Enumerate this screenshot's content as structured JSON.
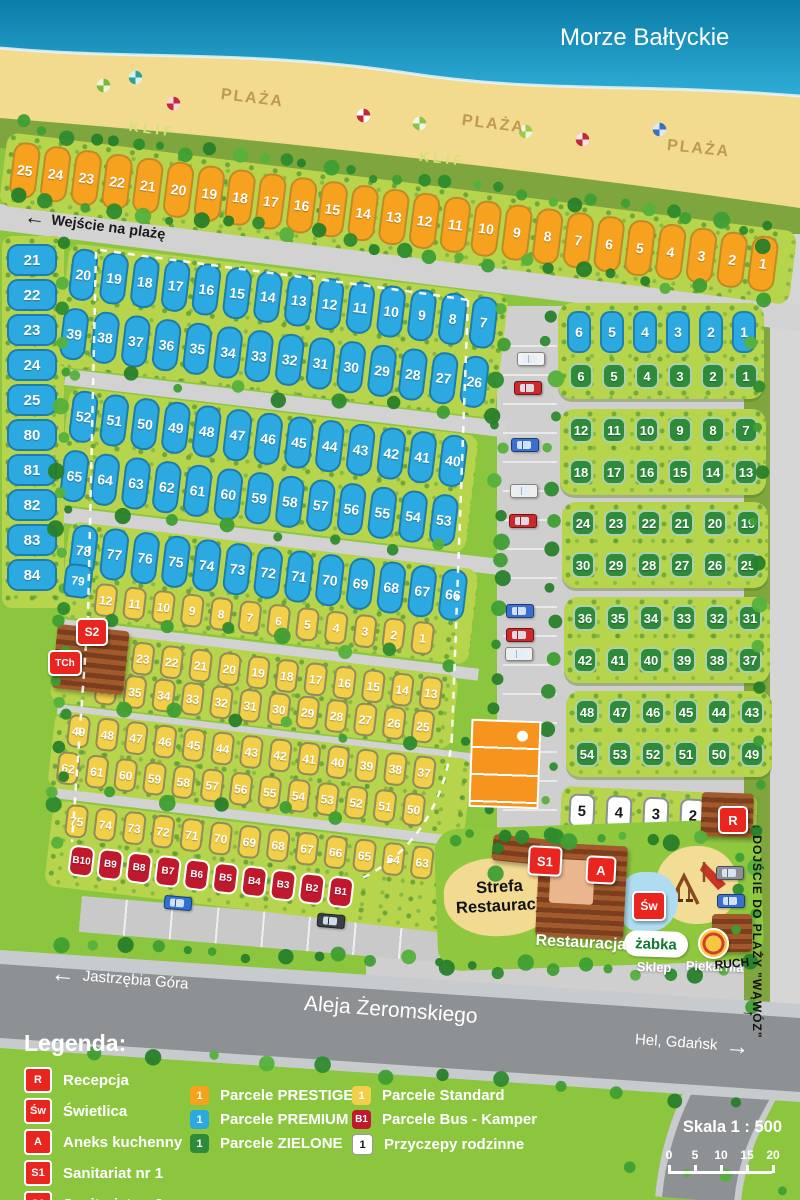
{
  "sea_label": "Morze Bałtyckie",
  "beach": {
    "plaza": [
      "PLAŻA",
      "PLAŻA",
      "PLAŻA"
    ],
    "klif": [
      "KLIF",
      "KLIF"
    ]
  },
  "paths": {
    "beach_entrance": "Wejście na plażę",
    "gorge_access": "DOJŚCIE DO PLAŻY \"WĄWÓZ\""
  },
  "roads": {
    "left_direction": "Jastrzębia Góra",
    "main_street": "Aleja Żeromskiego",
    "right_direction": "Hel, Gdańsk"
  },
  "zones": {
    "restaurant_area": "Strefa Restauracji",
    "restaurant": "Restauracja",
    "shop_logo": "żabka",
    "shop": "Sklep",
    "bakery": "Piekarnia",
    "kiosk": "RUCH"
  },
  "facilities": {
    "reception": "R",
    "common_room": "Św",
    "kitchen": "A",
    "sanitary1": "S1",
    "sanitary2": "S2",
    "chem_toilet": "TCh"
  },
  "plots": {
    "prestige": [
      "25",
      "24",
      "23",
      "22",
      "21",
      "20",
      "19",
      "18",
      "17",
      "16",
      "15",
      "14",
      "13",
      "12",
      "11",
      "10",
      "9",
      "8",
      "7",
      "6",
      "5",
      "4",
      "3",
      "2",
      "1"
    ],
    "premium_left_column": [
      "21",
      "22",
      "23",
      "24",
      "25",
      "80",
      "81",
      "82",
      "83",
      "84"
    ],
    "premium_rows": [
      [
        "20",
        "19",
        "18",
        "17",
        "16",
        "15",
        "14",
        "13",
        "12",
        "11",
        "10",
        "9",
        "8",
        "7"
      ],
      [
        "39",
        "38",
        "37",
        "36",
        "35",
        "34",
        "33",
        "32",
        "31",
        "30",
        "29",
        "28",
        "27",
        "26"
      ],
      [
        "52",
        "51",
        "50",
        "49",
        "48",
        "47",
        "46",
        "45",
        "44",
        "43",
        "42",
        "41",
        "40"
      ],
      [
        "65",
        "64",
        "63",
        "62",
        "61",
        "60",
        "59",
        "58",
        "57",
        "56",
        "55",
        "54",
        "53"
      ],
      [
        "78",
        "77",
        "76",
        "75",
        "74",
        "73",
        "72",
        "71",
        "70",
        "69",
        "68",
        "67",
        "66"
      ]
    ],
    "premium_extra": "79",
    "standard_rows": [
      [
        "12",
        "11",
        "10",
        "9",
        "8",
        "7",
        "6",
        "5",
        "4",
        "3",
        "2",
        "1"
      ],
      [
        "24",
        "23",
        "22",
        "21",
        "20",
        "19",
        "18",
        "17",
        "16",
        "15",
        "14",
        "13"
      ],
      [
        "36",
        "35",
        "34",
        "33",
        "32",
        "31",
        "30",
        "29",
        "28",
        "27",
        "26",
        "25"
      ],
      [
        "49",
        "48",
        "47",
        "46",
        "45",
        "44",
        "43",
        "42",
        "41",
        "40",
        "39",
        "38",
        "37"
      ],
      [
        "62",
        "61",
        "60",
        "59",
        "58",
        "57",
        "56",
        "55",
        "54",
        "53",
        "52",
        "51",
        "50"
      ],
      [
        "75",
        "74",
        "73",
        "72",
        "71",
        "70",
        "69",
        "68",
        "67",
        "66",
        "65",
        "64",
        "63"
      ]
    ],
    "bus": [
      "B10",
      "B9",
      "B8",
      "B7",
      "B6",
      "B5",
      "B4",
      "B3",
      "B2",
      "B1"
    ],
    "right_premium_row": [
      "6",
      "5",
      "4",
      "3",
      "2",
      "1"
    ],
    "green_rows": [
      [
        "6",
        "5",
        "4",
        "3",
        "2",
        "1"
      ],
      [
        "12",
        "11",
        "10",
        "9",
        "8",
        "7"
      ],
      [
        "18",
        "17",
        "16",
        "15",
        "14",
        "13"
      ],
      [
        "24",
        "23",
        "22",
        "21",
        "20",
        "19"
      ],
      [
        "30",
        "29",
        "28",
        "27",
        "26",
        "25"
      ],
      [
        "36",
        "35",
        "34",
        "33",
        "32",
        "31"
      ],
      [
        "42",
        "41",
        "40",
        "39",
        "38",
        "37"
      ],
      [
        "48",
        "47",
        "46",
        "45",
        "44",
        "43"
      ],
      [
        "54",
        "53",
        "52",
        "51",
        "50",
        "49"
      ]
    ],
    "family": [
      "5",
      "4",
      "3",
      "2",
      "1"
    ]
  },
  "legend": {
    "title": "Legenda:",
    "facilities": [
      {
        "icon": "R",
        "label": "Recepcja"
      },
      {
        "icon": "Św",
        "label": "Świetlica"
      },
      {
        "icon": "A",
        "label": "Aneks kuchenny"
      },
      {
        "icon": "S1",
        "label": "Sanitariat nr 1"
      },
      {
        "icon": "S2",
        "label": "Sanitariat nr 2"
      },
      {
        "icon": "TCh",
        "label": "Toaleta chemiczna"
      }
    ],
    "parcel_types": [
      {
        "icon": "1",
        "label": "Parcele PRESTIGE",
        "type": "prestige"
      },
      {
        "icon": "1",
        "label": "Parcele PREMIUM",
        "type": "premium"
      },
      {
        "icon": "1",
        "label": "Parcele ZIELONE",
        "type": "zielone"
      },
      {
        "icon": "1",
        "label": "Parcele Standard",
        "type": "standard"
      },
      {
        "icon": "B1",
        "label": "Parcele Bus - Kamper",
        "type": "bus"
      },
      {
        "icon": "1",
        "label": "Przyczepy rodzinne",
        "type": "family"
      }
    ]
  },
  "scale": {
    "label": "Skala 1 : 500",
    "ticks": [
      "0",
      "5",
      "10",
      "15",
      "20"
    ]
  },
  "colors": {
    "prestige": "#F7A21F",
    "premium": "#2BA9E0",
    "zielone": "#2E8B3A",
    "standard": "#F2CF49",
    "bus": "#C0182C",
    "family": "#FFFFFF",
    "facility_icon": "#E8251F",
    "camp_green": "#8CC63E",
    "sea": "#1697C2",
    "sand": "#F2DA8E"
  }
}
